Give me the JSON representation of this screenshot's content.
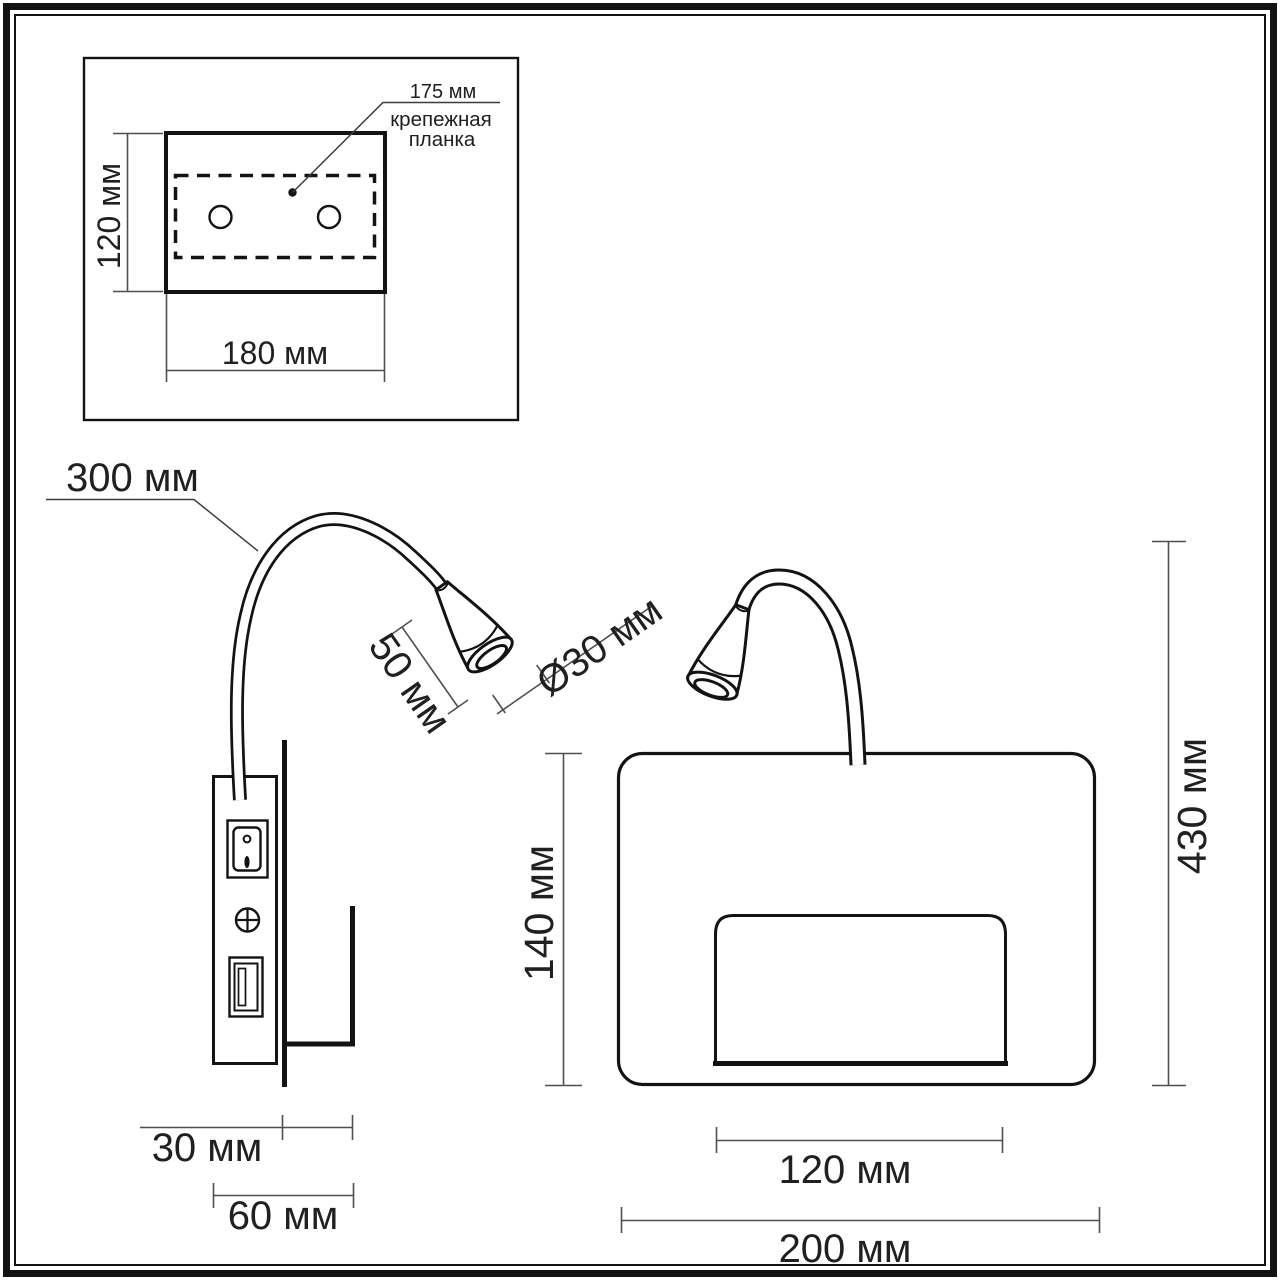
{
  "inset": {
    "height": "120 мм",
    "width": "180 мм",
    "mount_length": "175 мм",
    "mount_caption_1": "крепежная",
    "mount_caption_2": "планка"
  },
  "side_view": {
    "gooseneck_length": "300 мм",
    "head_length": "50 мм",
    "head_diameter": "Ø30 мм",
    "wall_offset": "30 мм",
    "total_depth": "60 мм"
  },
  "front_view": {
    "body_height": "140 мм",
    "overall_height": "430 мм",
    "recess_width": "120 мм",
    "body_width": "200 мм"
  }
}
